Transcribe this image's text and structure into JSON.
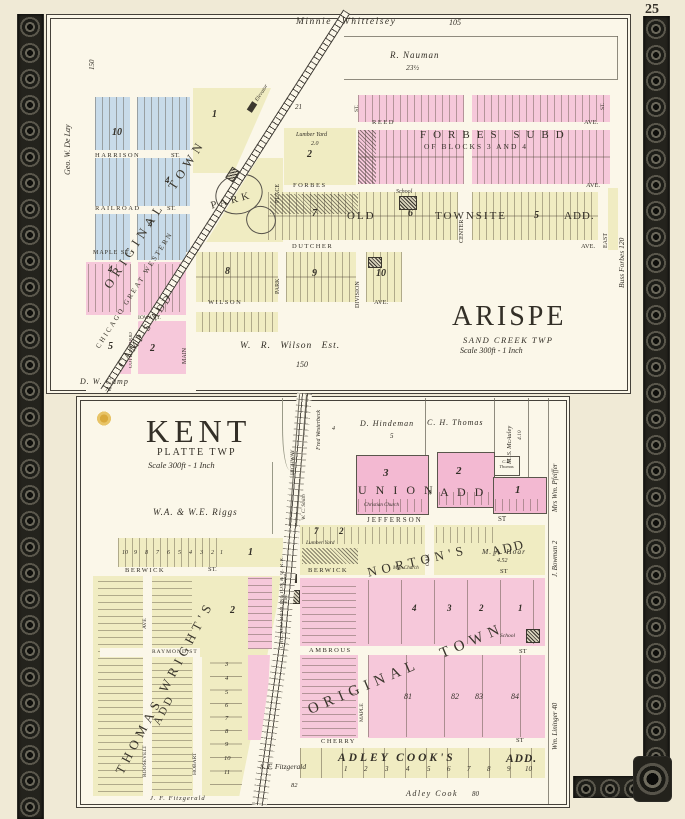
{
  "page": {
    "number": "25"
  },
  "arispe": {
    "title": "ARISPE",
    "township": "SAND CREEK TWP",
    "scale": "Scale 300ft - 1 Inch",
    "railroad": "CHICAGO GREAT WESTERN",
    "owners": {
      "whittelsey": "Minnie Whittelsey",
      "whittelsey_acres": "105",
      "nauman": "R. Nauman",
      "nauman_acres": "23½",
      "delay": "Geo. W. De Lay",
      "delay_acres": "150",
      "wilson": "W. R. Wilson Est.",
      "wilson_acres": "150",
      "camp": "D. W. Camp",
      "camp_acres": "72",
      "forbes": "Buss Forbes  120"
    },
    "subdivisions": {
      "original_town": "ORIGINAL  TOWN",
      "forbes1": "FORBES SUBD",
      "forbes2": "OF BLOCKS 3 AND 4",
      "old": "OLD",
      "townsite": "TOWNSITE",
      "add": "ADD.",
      "camps": "CAMP'S  ADD",
      "park": "PARK"
    },
    "streets": {
      "harrison": "HARRISON",
      "railroad": "RAILROAD",
      "maple": "MAPLE ST.",
      "reed": "REED",
      "forbes": "FORBES",
      "dutcher": "DUTCHER",
      "wilson": "WILSON",
      "place": "PLACE",
      "center": "CENTER",
      "east": "EAST",
      "park": "PARK",
      "division": "DIVISION",
      "main": "MAIN",
      "cottonwood": "COTTONWOOD",
      "iowa": "IOWA ST.",
      "st": "ST.",
      "ave": "AVE."
    },
    "blocks": {
      "b1": "1",
      "b2": "2",
      "b3": "3",
      "b4": "4",
      "b5": "5",
      "b6": "6",
      "b7": "7",
      "b8": "8",
      "b9": "9",
      "b10": "10",
      "b21": "21",
      "c2": "2",
      "c4": "4",
      "c5": "5"
    },
    "features": {
      "lumber": "Lumber Yard",
      "lumber_acres": "2.0",
      "school": "School",
      "elevator": "Elevator"
    }
  },
  "kent": {
    "title": "KENT",
    "township": "PLATTE TWP",
    "scale": "Scale 300ft - 1 Inch",
    "railroad": "CHICAGO BURLINGTON & Q. R.R.",
    "owners": {
      "riggs": "W.A. & W.E. Riggs",
      "westerbeck": "Fred Westerbeck",
      "westerbeck_acres": "4",
      "hindeman": "D. Hindeman",
      "hindeman_acres": "5",
      "thomas": "C. H. Thomas",
      "mcauley": "M. S. McAuley",
      "mcauley_acres": "4.10",
      "thomas2": "C.H. Thomas",
      "pfeiffer": "Mrs Wm. Pfeiffer",
      "bowman": "J. Bowman  2",
      "lininger": "Wm. Lininger  40",
      "smith": "W. C. Smith",
      "hoar": "M. A. Hoar",
      "hoar_acres": "4.52",
      "fitzgerald_s": "S. F. Fitzgerald",
      "fitzgerald_s_acres": "82",
      "fitzgerald_j": "J. F. Fitzgerald",
      "cook": "Adley Cook",
      "cook_acres": "80"
    },
    "subdivisions": {
      "union": "U N I O N",
      "union_add": "A D D",
      "nortons": "NORTON'S",
      "nortons_add": "ADD",
      "original": "ORIGINAL  TOWN",
      "wrights": "THOMAS WRIGHT'S",
      "wrights_add": "ADD",
      "adley": "ADLEY  COOK'S",
      "adley_add": "ADD."
    },
    "streets": {
      "jefferson": "JEFFERSON",
      "berwick": "BERWICK",
      "raymond": "RAYMOND ST",
      "ambrous": "AMBROUS",
      "cherry": "CHERRY",
      "oak": "OAK",
      "maple": "MAPLE",
      "roosevelt": "ROOSEVELT",
      "ave": "AVE",
      "hobart": "HOBART",
      "highway": "HIGHWAY",
      "st": "ST",
      "st_dot": "ST."
    },
    "blocks": {
      "u1": "1",
      "u2": "2",
      "u3": "3",
      "n2": "2",
      "n7": "7",
      "o1": "1",
      "o2": "2",
      "o3": "3",
      "o4": "4",
      "w1": "1",
      "w2": "2",
      "l81": "81",
      "l82": "82",
      "l83": "83",
      "l84": "84"
    },
    "lots_top": [
      "10",
      "9",
      "8",
      "7",
      "6",
      "5",
      "4",
      "3",
      "2",
      "1"
    ],
    "lots_right": [
      "3",
      "4",
      "5",
      "6",
      "7",
      "8",
      "9",
      "10",
      "11"
    ],
    "lots_adley": [
      "1",
      "2",
      "3",
      "4",
      "5",
      "6",
      "7",
      "8",
      "9",
      "10"
    ],
    "features": {
      "school": "School",
      "lumber": "Lumber Yard",
      "me_church": "M.E. Church",
      "christian_church": "Christian Church",
      "depot": "Depot",
      "elev": "Elev."
    }
  }
}
